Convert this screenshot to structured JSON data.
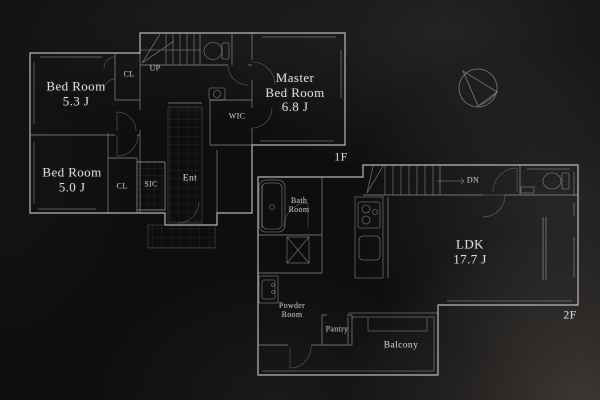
{
  "scene": {
    "kind": "architectural floor plan, two storeys, dark blueprint style"
  },
  "palette": {
    "background": "#0e0e0e",
    "wall_line": "#e0e0e0",
    "detail_line": "#b9b9b9",
    "text": "#d4d4d4"
  },
  "floor1": {
    "label": "1F",
    "bedroom1": {
      "name": "Bed Room",
      "area": "5.3 J"
    },
    "bedroom2": {
      "name": "Bed Room",
      "area": "5.0 J"
    },
    "master": {
      "name_line1": "Master",
      "name_line2": "Bed Room",
      "area": "6.8 J"
    },
    "closet1": "CL",
    "closet2": "CL",
    "stairs": "UP",
    "wic": "WIC",
    "sic": "SIC",
    "entrance": "Ent"
  },
  "floor2": {
    "label": "2F",
    "ldk": {
      "name": "LDK",
      "area": "17.7 J"
    },
    "bath": {
      "name_line1": "Bath",
      "name_line2": "Room"
    },
    "powder": {
      "name_line1": "Powder",
      "name_line2": "Room"
    },
    "pantry": "Pantry",
    "balcony": "Balcony",
    "stairs": "DN"
  },
  "compass": {
    "icon": "north-arrow"
  }
}
